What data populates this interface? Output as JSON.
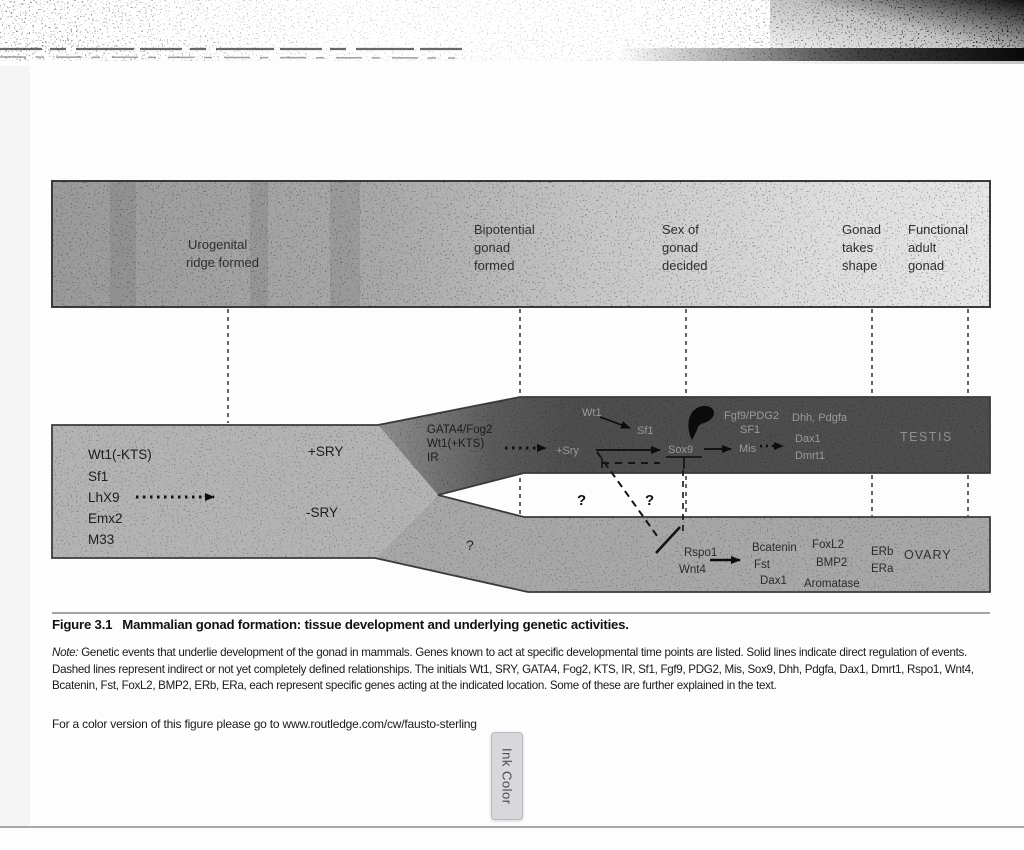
{
  "timeline": {
    "stages": [
      {
        "lines": [
          "Urogenital",
          "ridge formed"
        ]
      },
      {
        "lines": [
          "Bipotential",
          "gonad",
          "formed"
        ]
      },
      {
        "lines": [
          "Sex of",
          "gonad",
          "decided"
        ]
      },
      {
        "lines": [
          "Gonad",
          "takes",
          "shape"
        ]
      },
      {
        "lines": [
          "Functional",
          "adult",
          "gonad"
        ]
      }
    ]
  },
  "diagram": {
    "bipotential_genes": [
      "Wt1(-KTS)",
      "Sf1",
      "LhX9",
      "Emx2",
      "M33"
    ],
    "sry_plus": "+SRY",
    "sry_minus": "-SRY",
    "junction_genes": [
      "GATA4/Fog2",
      "Wt1(+KTS)",
      "IR"
    ],
    "testis_path": {
      "wt1": "Wt1",
      "sf1": "Sf1",
      "fgf9": "Fgf9/PDG2",
      "sf1b": "SF1",
      "sry": "+Sry",
      "sox9": "Sox9",
      "mis": "Mis",
      "late_genes": [
        "Dhh, Pdgfa",
        "Dax1",
        "Dmrt1"
      ],
      "label": "TESTIS"
    },
    "ovary_path": {
      "rspo1": "Rspo1",
      "wnt4": "Wnt4",
      "mid_genes": [
        "Bcatenin",
        "Fst",
        "Dax1"
      ],
      "late_genes": [
        "FoxL2",
        "BMP2",
        "Aromatase"
      ],
      "receptors": [
        "ERb",
        "ERa"
      ],
      "label": "OVARY"
    },
    "question_marks": {
      "gap1": "?",
      "gap2": "?",
      "ovary": "?"
    }
  },
  "caption": {
    "figure_label": "Figure 3.1",
    "figure_title": "Mammalian gonad formation: tissue development and underlying genetic activities.",
    "note_label": "Note:",
    "note_text": "Genetic events that underlie development of the gonad in mammals. Genes known to act at specific developmental time points are listed. Solid lines indicate direct regulation of events. Dashed lines represent indirect or not yet completely defined relationships. The initials Wt1, SRY, GATA4, Fog2, KTS, IR, Sf1, Fgf9, PDG2, Mis, Sox9, Dhh, Pdgfa, Dax1, Dmrt1, Rspo1, Wnt4, Bcatenin, Fst, FoxL2, BMP2, ERb, ERa, each represent specific genes acting at the indicated location. Some of these are further explained in the text.",
    "color_version_text": "For a color version of this figure please go to www.routledge.com/cw/fausto-sterling"
  },
  "viewer": {
    "ink_color_tab": "Ink Color"
  },
  "colors": {
    "testis_band": "#4d4d4d",
    "ovary_band": "#a7a7a7",
    "bipotential_band": "#b3b3b3",
    "timeline_bar_left": "#9c9c9c",
    "timeline_bar_right": "#e6e6e6",
    "ink_tab_bg": "#d8d8dc"
  }
}
